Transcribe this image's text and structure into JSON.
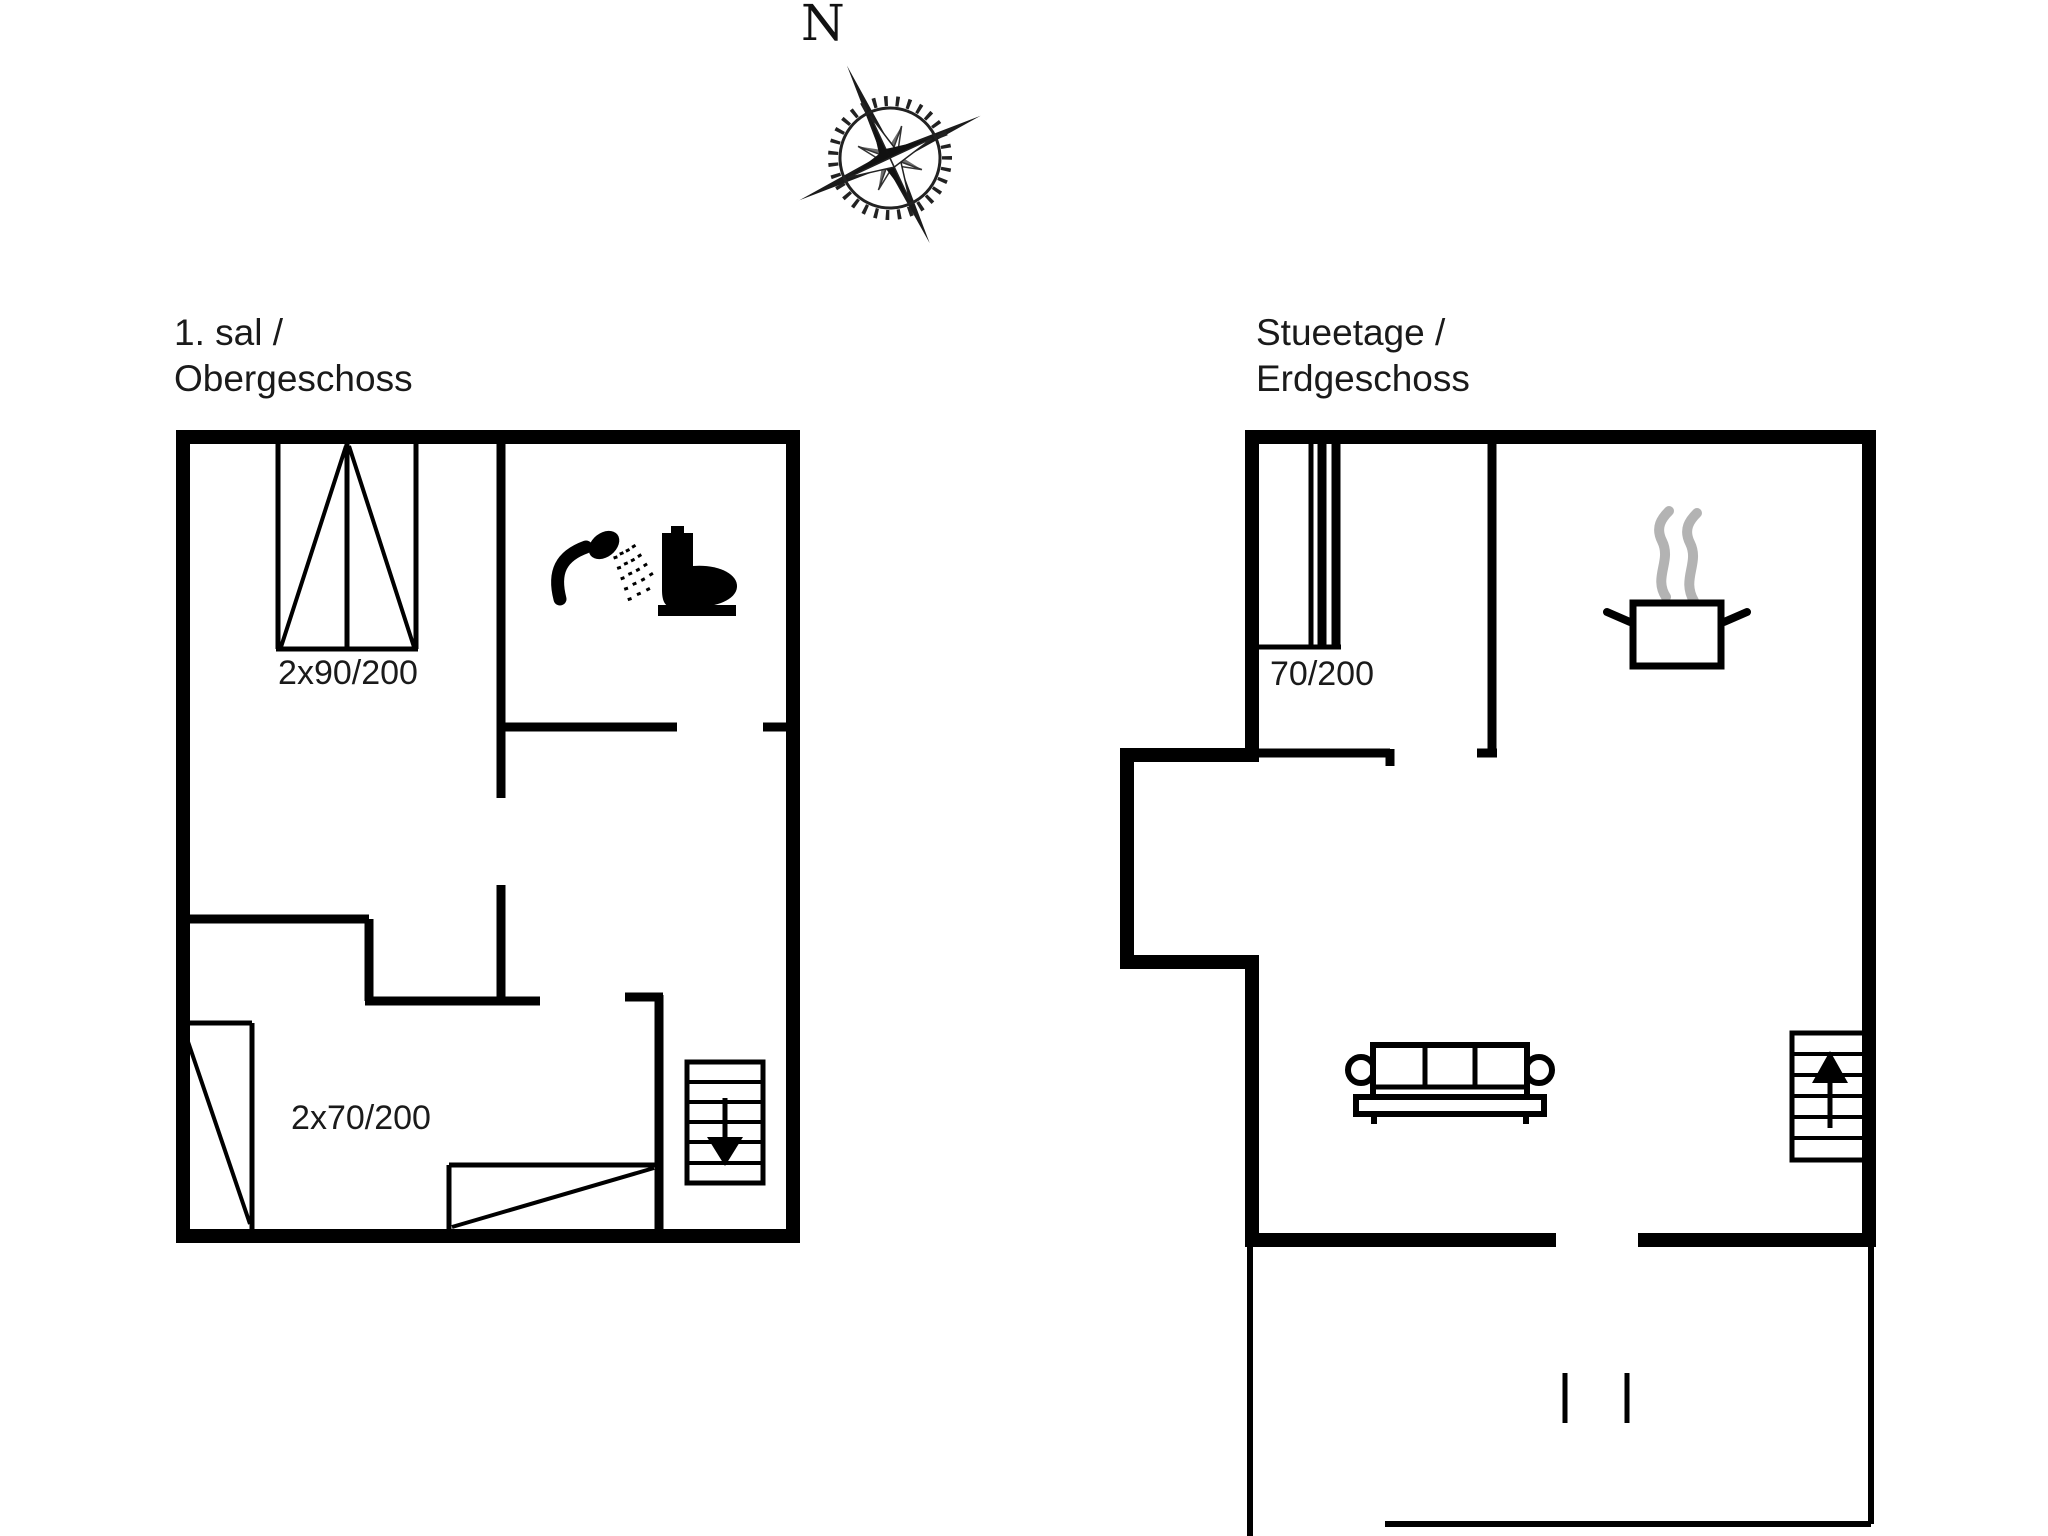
{
  "colors": {
    "wall": "#000000",
    "background": "#ffffff",
    "steam_gray": "#b3b3b3",
    "text": "#1a1a1a"
  },
  "compass": {
    "north_label": "N"
  },
  "upper_floor": {
    "title_line1": "1. sal /",
    "title_line2": "Obergeschoss",
    "window_top_label": "2x90/200",
    "window_bottom_label": "2x70/200"
  },
  "ground_floor": {
    "title_line1": "Stueetage /",
    "title_line2": "Erdgeschoss",
    "door_label": "70/200"
  },
  "icons": {
    "compass_rose": "compass-rose-icon",
    "stairs_down": "stairs-down-icon",
    "stairs_up": "stairs-up-icon",
    "shower": "shower-icon",
    "toilet": "toilet-icon",
    "cooking_pot": "cooking-pot-icon",
    "steam": "steam-icon",
    "sofa": "sofa-icon"
  }
}
